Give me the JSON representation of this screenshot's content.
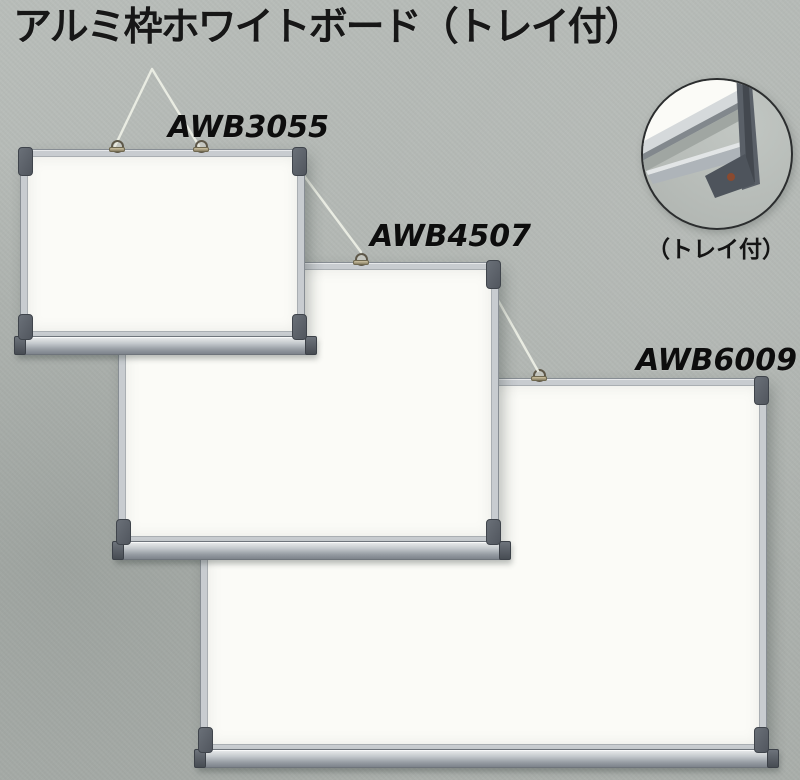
{
  "page": {
    "title": "アルミ枠ホワイトボード（トレイ付）"
  },
  "products": [
    {
      "model": "AWB3055"
    },
    {
      "model": "AWB4507"
    },
    {
      "model": "AWB6009"
    }
  ],
  "inset": {
    "caption": "（トレイ付）"
  },
  "colors": {
    "background": "#b3b8b4",
    "frame_aluminum": "#c8ccd0",
    "corner_cap": "#5d636b",
    "board_surface": "#fbfbf7",
    "text": "#171717",
    "string": "#efefe6"
  }
}
